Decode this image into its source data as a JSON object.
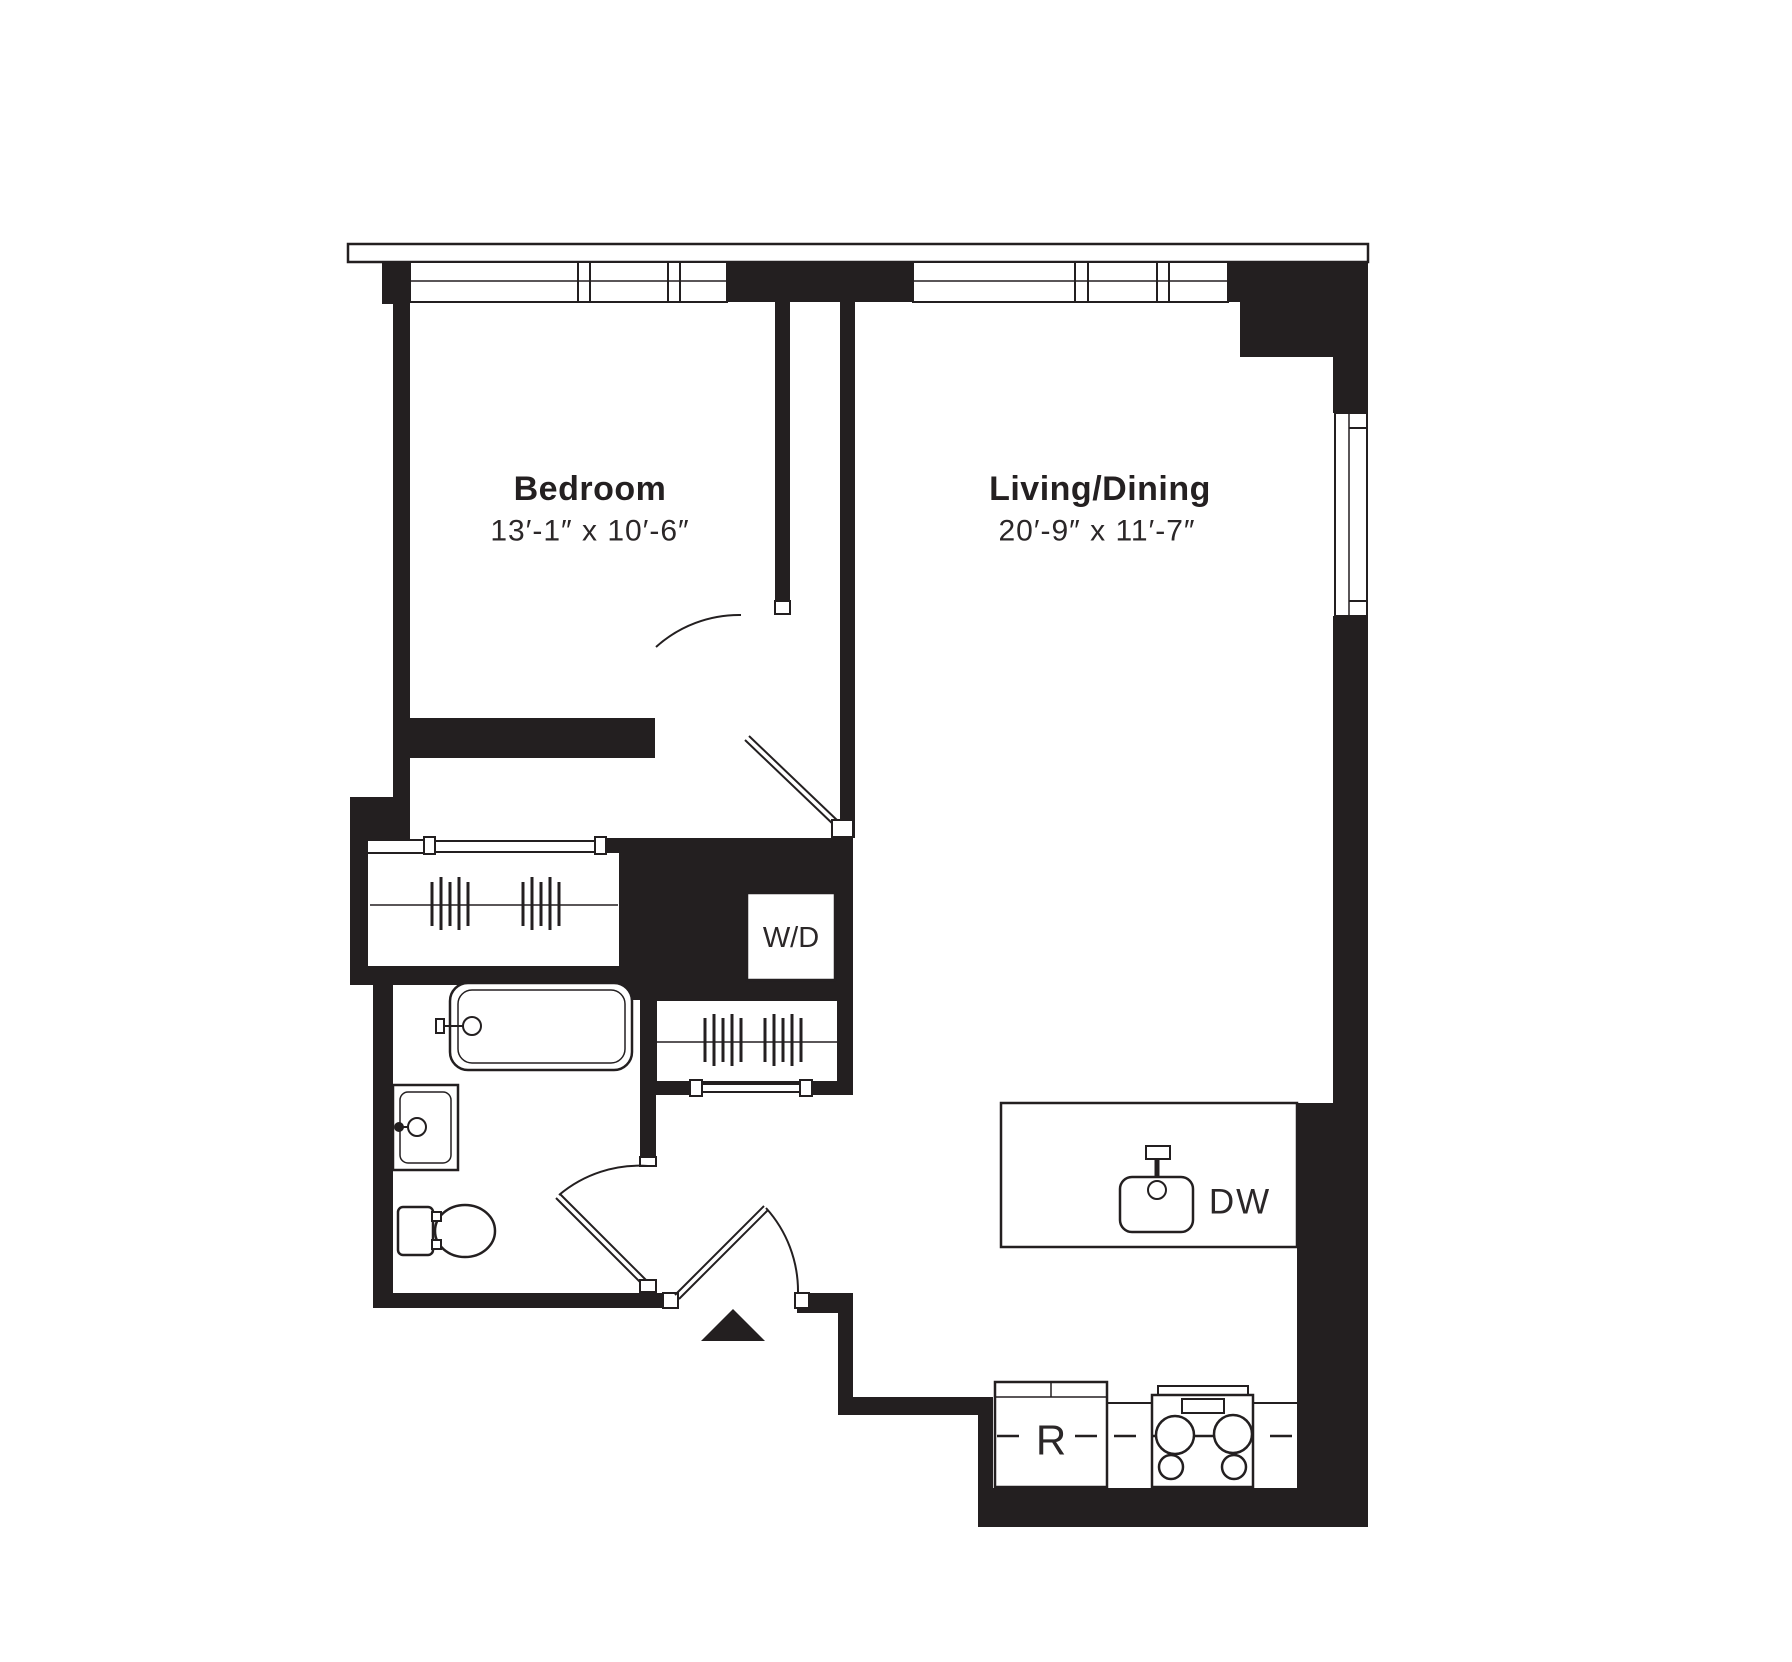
{
  "plan": {
    "rooms": [
      {
        "name": "Bedroom",
        "dimensions": "13′-1″ x 10′-6″"
      },
      {
        "name": "Living/Dining",
        "dimensions": "20′-9″ x 11′-7″"
      }
    ],
    "labels": {
      "washer_dryer": "W/D",
      "dishwasher": "DW",
      "refrigerator": "R"
    },
    "colors": {
      "wall": "#231f20",
      "line": "#231f20",
      "background": "#ffffff"
    }
  }
}
